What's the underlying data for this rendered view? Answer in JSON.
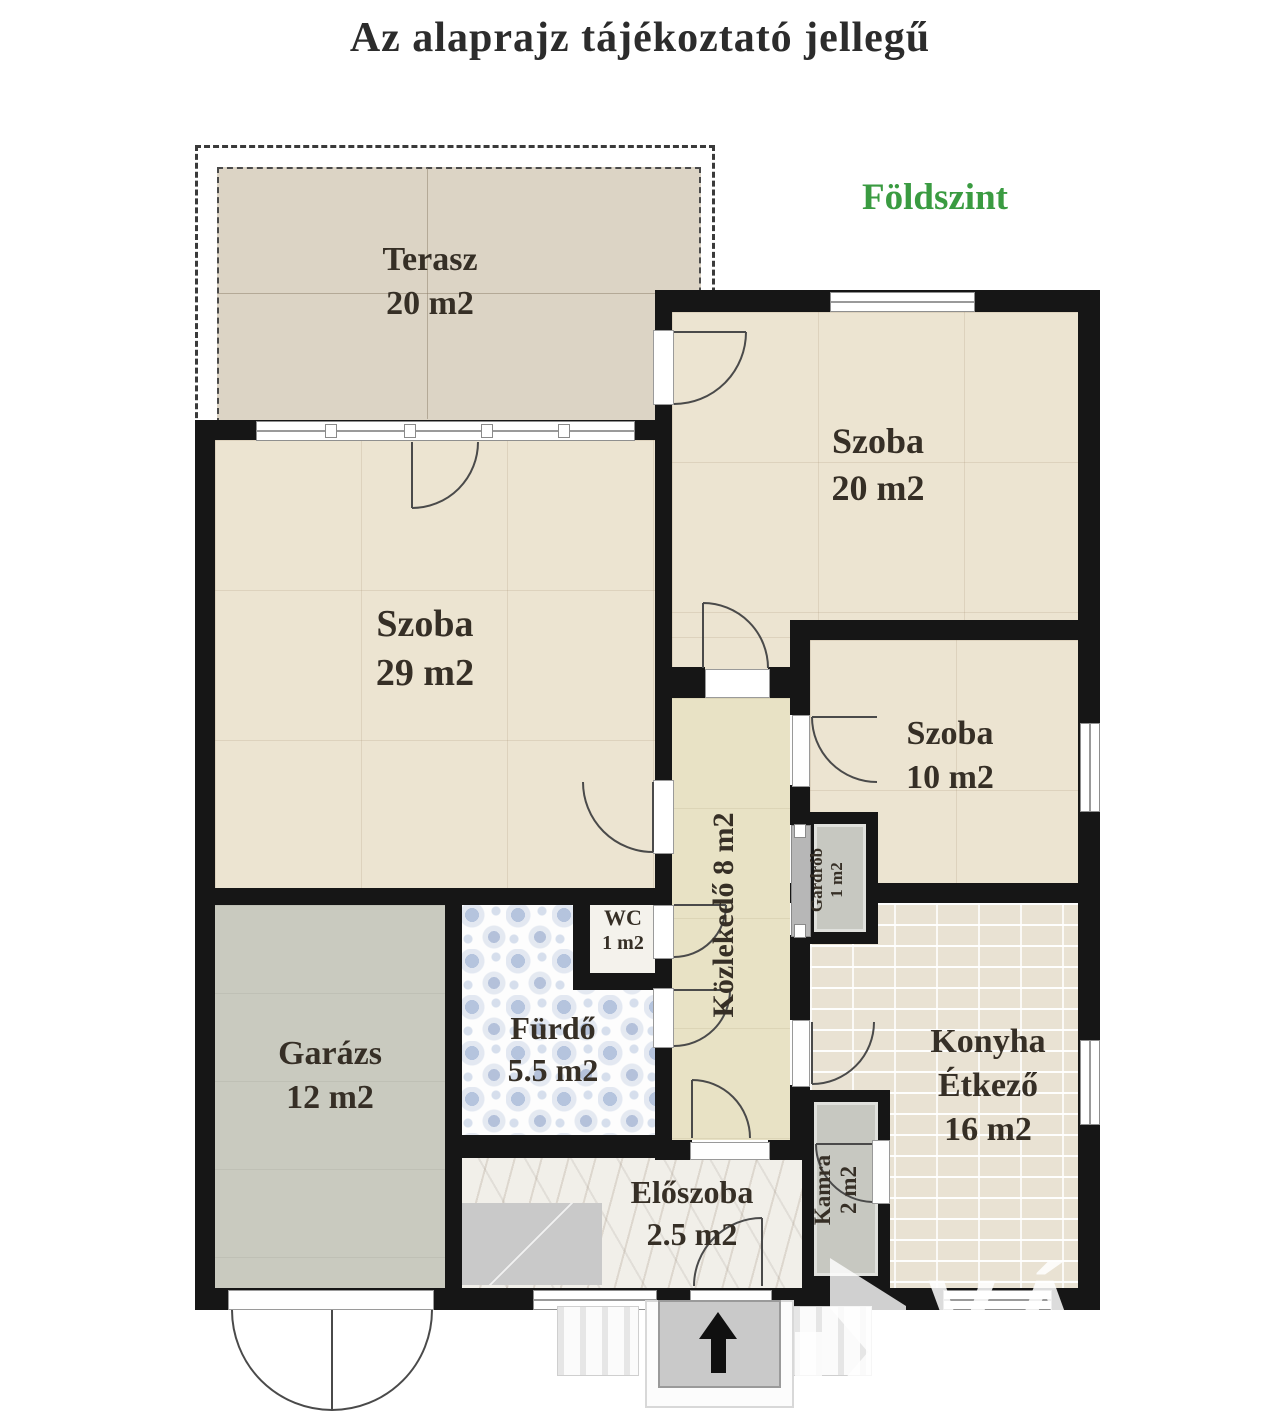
{
  "title": "Az alaprajz tájékoztató jellegű",
  "floor_label": "Földszint",
  "rooms": [
    {
      "name": "Terasz",
      "area": "20 m2"
    },
    {
      "name": "Szoba",
      "area": "29 m2"
    },
    {
      "name": "Szoba",
      "area": "20 m2"
    },
    {
      "name": "Szoba",
      "area": "10 m2"
    },
    {
      "name": "Közlekedő",
      "area": "8 m2"
    },
    {
      "name": "Gardrób",
      "area": "1 m2"
    },
    {
      "name": "WC",
      "area": "1 m2"
    },
    {
      "name": "Fürdő",
      "area": "5.5 m2"
    },
    {
      "name": "Garázs",
      "area": "12 m2"
    },
    {
      "name": "Konyha",
      "subname": "Étkező",
      "area": "16 m2"
    },
    {
      "name": "Kamra",
      "area": "2 m2"
    },
    {
      "name": "Előszoba",
      "area": "2.5 m2"
    }
  ],
  "watermark": {
    "text": "VÁRO"
  },
  "colors": {
    "floor_label_green": "#3a9b41",
    "wall_black": "#161616",
    "title_text": "#2c2c2c",
    "watermark_white": "#ffffff"
  }
}
